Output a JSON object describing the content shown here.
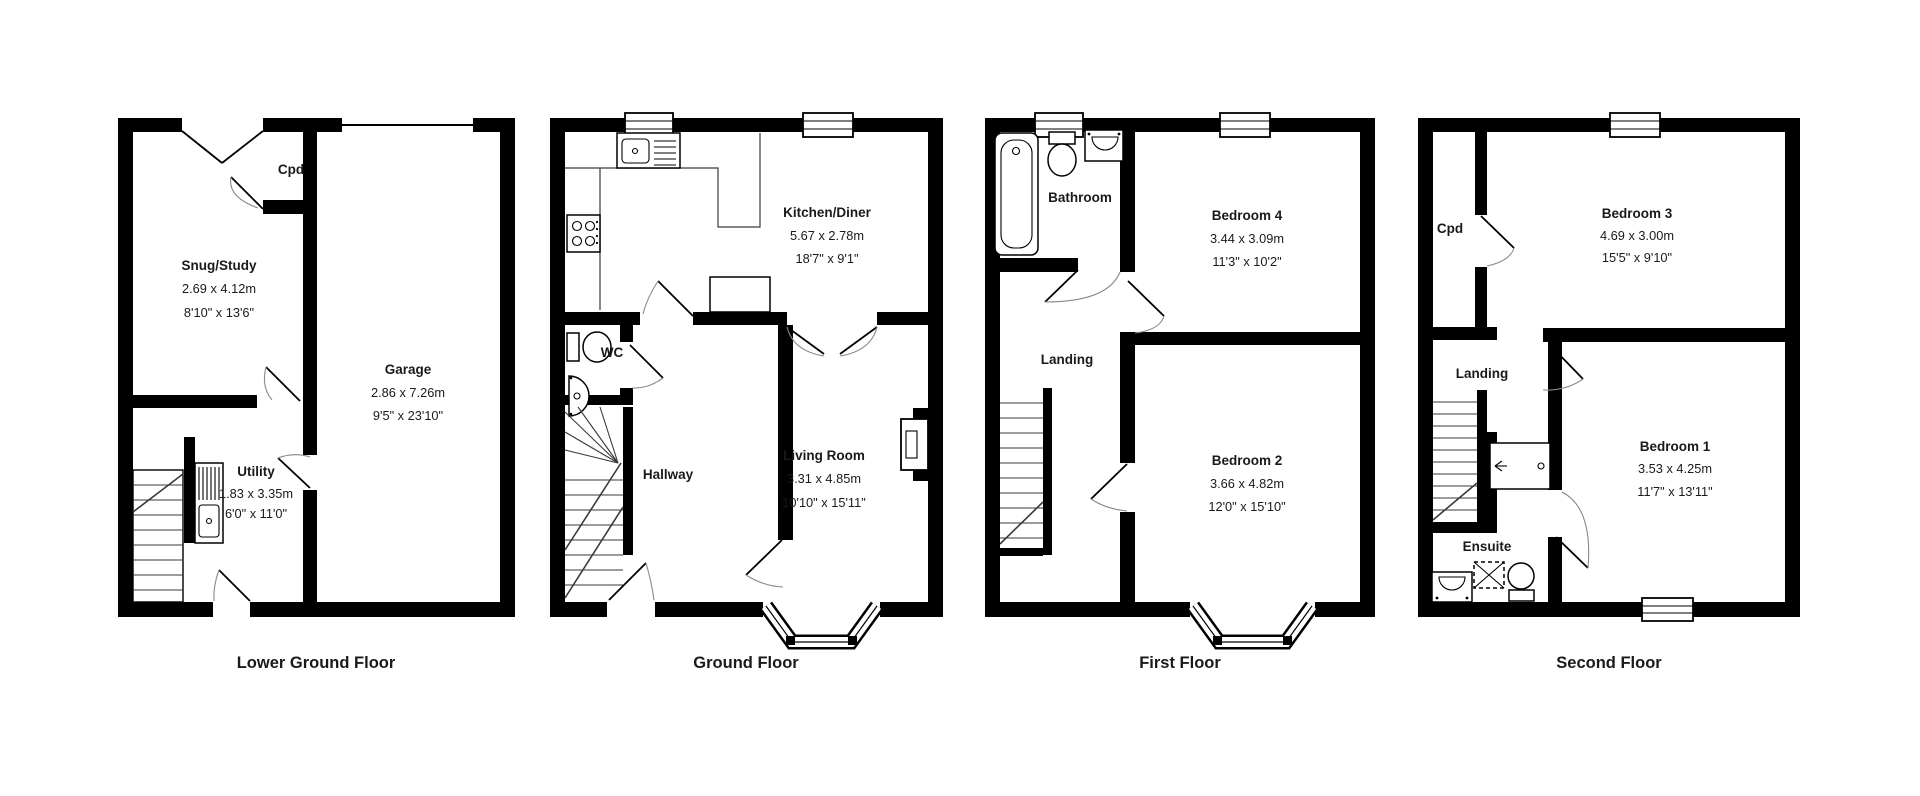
{
  "floors": [
    {
      "label": "Lower Ground Floor",
      "rooms": {
        "snug": {
          "name": "Snug/Study",
          "metric": "2.69 x 4.12m",
          "imperial": "8'10\" x 13'6\""
        },
        "cpd": {
          "name": "Cpd"
        },
        "garage": {
          "name": "Garage",
          "metric": "2.86 x 7.26m",
          "imperial": "9'5\" x 23'10\""
        },
        "utility": {
          "name": "Utility",
          "metric": "1.83 x 3.35m",
          "imperial": "6'0\" x 11'0\""
        }
      }
    },
    {
      "label": "Ground Floor",
      "rooms": {
        "kitchen": {
          "name": "Kitchen/Diner",
          "metric": "5.67 x 2.78m",
          "imperial": "18'7\" x 9'1\""
        },
        "wc": {
          "name": "WC"
        },
        "hallway": {
          "name": "Hallway"
        },
        "living": {
          "name": "Living Room",
          "metric": "3.31 x 4.85m",
          "imperial": "10'10\" x 15'11\""
        }
      }
    },
    {
      "label": "First Floor",
      "rooms": {
        "bathroom": {
          "name": "Bathroom"
        },
        "bed4": {
          "name": "Bedroom 4",
          "metric": "3.44 x 3.09m",
          "imperial": "11'3\" x 10'2\""
        },
        "landing": {
          "name": "Landing"
        },
        "bed2": {
          "name": "Bedroom 2",
          "metric": "3.66 x 4.82m",
          "imperial": "12'0\" x 15'10\""
        }
      }
    },
    {
      "label": "Second Floor",
      "rooms": {
        "cpd": {
          "name": "Cpd"
        },
        "bed3": {
          "name": "Bedroom 3",
          "metric": "4.69 x 3.00m",
          "imperial": "15'5\" x 9'10\""
        },
        "landing": {
          "name": "Landing"
        },
        "bed1": {
          "name": "Bedroom 1",
          "metric": "3.53 x 4.25m",
          "imperial": "11'7\" x 13'11\""
        },
        "ensuite": {
          "name": "Ensuite"
        }
      }
    }
  ],
  "colors": {
    "wall": "#000000",
    "background": "#ffffff",
    "text": "#1a1a1a"
  }
}
